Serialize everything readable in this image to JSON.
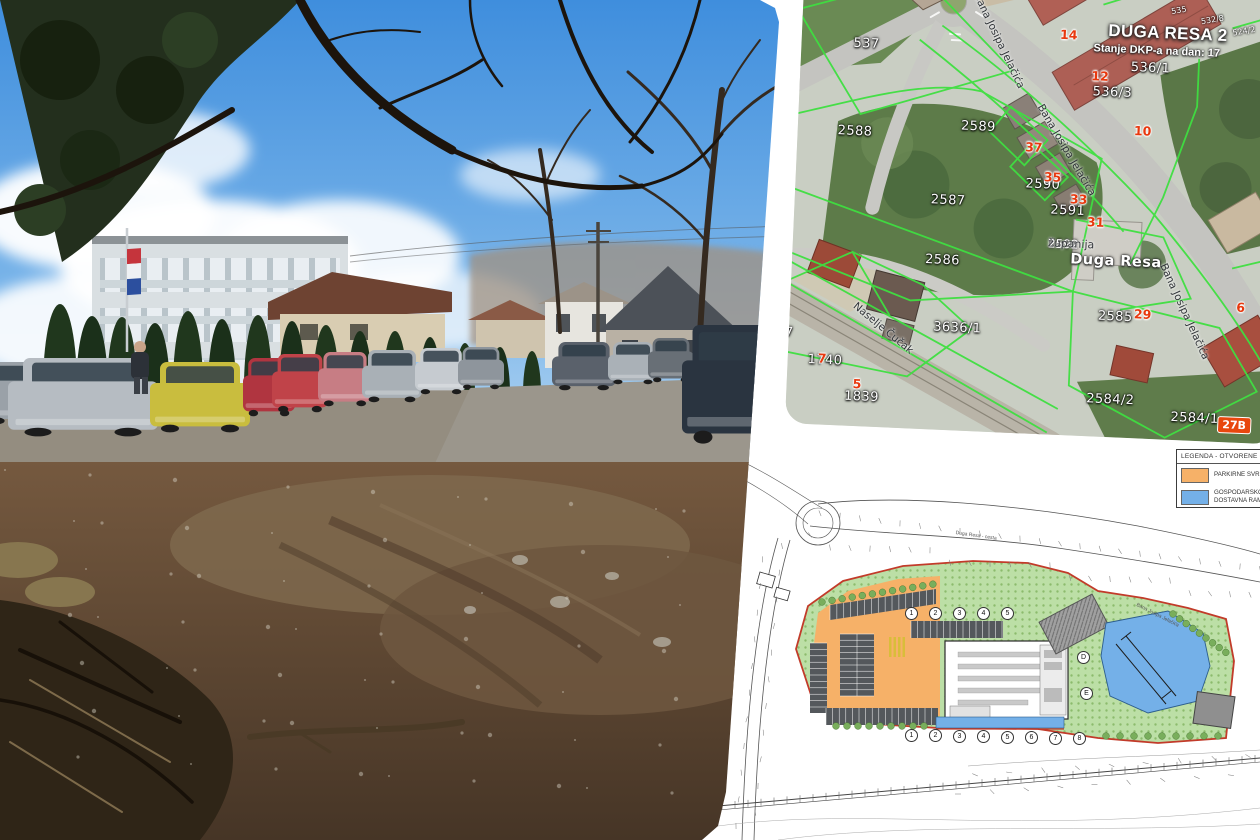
{
  "collage": {
    "background": "#ffffff"
  },
  "photo": {
    "scene": "vacant muddy-gravel lot with a row of parked cars, school building with Croatian flag, cypress hedge, bare tree branches overhead",
    "colors": {
      "sky_top": "#3f8edd",
      "sky_low": "#a9cdf0",
      "cloud": "#ffffff",
      "gravel": "#948d80",
      "mud": "#6f5740",
      "mud_dark": "#4a3826",
      "foliage_dark": "#232f1d",
      "cypress": "#20371d",
      "school_wall": "#d9dfe2",
      "roof_brown": "#6e4332",
      "roof_dark": "#4c5158",
      "flag_red": "#c5343c",
      "flag_white": "#eef1f4",
      "flag_blue": "#2c4f9e"
    },
    "car_colors": [
      "#9aa1a8",
      "#b6bcc2",
      "#c9bd3e",
      "#b03540",
      "#c04349",
      "#c77d84",
      "#a9b0b6",
      "#c6cbd0",
      "#8e959c",
      "#5a616b",
      "#aab1b7",
      "#686f76",
      "#2a3440"
    ]
  },
  "map": {
    "title": "DUGA RESA 2",
    "subtitle": "Stanje DKP-a na dan: 17",
    "city": "Duga Resa",
    "county_prefix": "Karlo",
    "county_parcel": "2592",
    "county_suffix": "županija",
    "boundary_color": "#3fdf41",
    "house_number_color": "#e8380e",
    "labels": [
      {
        "t": "537",
        "x": 52,
        "y": 84,
        "k": "parcel"
      },
      {
        "t": "2588",
        "x": 40,
        "y": 172,
        "k": "parcel"
      },
      {
        "t": "2589",
        "x": 163,
        "y": 162,
        "k": "parcel"
      },
      {
        "t": "2587",
        "x": 136,
        "y": 237,
        "k": "parcel"
      },
      {
        "t": "2590",
        "x": 230,
        "y": 217,
        "k": "parcel"
      },
      {
        "t": "2591",
        "x": 256,
        "y": 242,
        "k": "parcel"
      },
      {
        "t": "2586",
        "x": 133,
        "y": 297,
        "k": "parcel"
      },
      {
        "t": "2585",
        "x": 308,
        "y": 346,
        "k": "parcel"
      },
      {
        "t": "3636/1",
        "x": 144,
        "y": 364,
        "k": "parcel"
      },
      {
        "t": "1847",
        "x": -30,
        "y": 376,
        "k": "parcel"
      },
      {
        "t": "1740",
        "x": 20,
        "y": 402,
        "k": "parcel"
      },
      {
        "t": "1839",
        "x": 58,
        "y": 437,
        "k": "parcel"
      },
      {
        "t": "536/1",
        "x": 330,
        "y": 96,
        "k": "parcel"
      },
      {
        "t": "536/3",
        "x": 293,
        "y": 122,
        "k": "parcel"
      },
      {
        "t": "2584/2",
        "x": 300,
        "y": 429,
        "k": "parcel"
      },
      {
        "t": "2584/1",
        "x": 385,
        "y": 444,
        "k": "parcel"
      },
      {
        "t": "535",
        "x": 368,
        "y": 40,
        "k": "tiny",
        "r": -12
      },
      {
        "t": "532/8",
        "x": 398,
        "y": 48,
        "k": "tiny",
        "r": -12
      },
      {
        "t": "524/2",
        "x": 430,
        "y": 58,
        "k": "tiny",
        "r": -12
      },
      {
        "t": "14",
        "x": 258,
        "y": 66,
        "k": "house"
      },
      {
        "t": "12",
        "x": 291,
        "y": 106,
        "k": "house"
      },
      {
        "t": "10",
        "x": 336,
        "y": 159,
        "k": "house"
      },
      {
        "t": "37",
        "x": 228,
        "y": 180,
        "k": "house"
      },
      {
        "t": "35",
        "x": 248,
        "y": 209,
        "k": "house"
      },
      {
        "t": "33",
        "x": 275,
        "y": 230,
        "k": "house"
      },
      {
        "t": "31",
        "x": 293,
        "y": 252,
        "k": "house"
      },
      {
        "t": "29",
        "x": 344,
        "y": 342,
        "k": "house"
      },
      {
        "t": "6",
        "x": 446,
        "y": 331,
        "k": "house"
      },
      {
        "t": "9",
        "x": -14,
        "y": 379,
        "k": "house"
      },
      {
        "t": "7",
        "x": 30,
        "y": 400,
        "k": "house"
      },
      {
        "t": "5",
        "x": 66,
        "y": 424,
        "k": "house"
      },
      {
        "t": "27B",
        "x": 432,
        "y": 448,
        "k": "badge"
      },
      {
        "t": "Bana Josipa Jelačića",
        "x": 178,
        "y": 34,
        "k": "street",
        "r": 62
      },
      {
        "t": "Bana Josipa Jelačića",
        "x": 246,
        "y": 142,
        "k": "street",
        "r": 57
      },
      {
        "t": "Bana Josipa Jelačića",
        "x": 376,
        "y": 296,
        "k": "street",
        "r": 63
      },
      {
        "t": "Naselje Čučak",
        "x": 68,
        "y": 348,
        "k": "street",
        "r": 37
      }
    ]
  },
  "plan": {
    "legend": {
      "title": "LEGENDA - OTVORENE GRA",
      "items": [
        {
          "line1": "PARKIRNE SVRH",
          "line2": "",
          "color": "#f6b168"
        },
        {
          "line1": "GOSPODARSKO",
          "line2": "DOSTAVNA RAM",
          "color": "#74b0e8"
        }
      ]
    },
    "grid_top": [
      {
        "n": "1",
        "x": 192,
        "y": 206
      },
      {
        "n": "2",
        "x": 216,
        "y": 206
      },
      {
        "n": "3",
        "x": 240,
        "y": 206
      },
      {
        "n": "4",
        "x": 264,
        "y": 206
      },
      {
        "n": "5",
        "x": 288,
        "y": 206
      }
    ],
    "grid_bottom": [
      {
        "n": "1",
        "x": 192,
        "y": 328
      },
      {
        "n": "2",
        "x": 216,
        "y": 328
      },
      {
        "n": "3",
        "x": 240,
        "y": 329
      },
      {
        "n": "4",
        "x": 264,
        "y": 329
      },
      {
        "n": "5",
        "x": 288,
        "y": 330
      },
      {
        "n": "6",
        "x": 312,
        "y": 330
      },
      {
        "n": "7",
        "x": 336,
        "y": 331
      },
      {
        "n": "8",
        "x": 360,
        "y": 331
      }
    ],
    "grid_side": [
      {
        "n": "D",
        "x": 364,
        "y": 250
      },
      {
        "n": "E",
        "x": 367,
        "y": 286
      }
    ],
    "road_labels": [
      {
        "t": "Duga Resa - cesta",
        "x": 238,
        "y": 124,
        "r": 8
      },
      {
        "t": "Bana Josipa Jelačića",
        "x": 420,
        "y": 196,
        "r": 27
      }
    ],
    "colors": {
      "parking": "#f6b168",
      "delivery": "#74b0e8",
      "green": "#bcdfa6",
      "boundary": "#c23b2a"
    }
  }
}
